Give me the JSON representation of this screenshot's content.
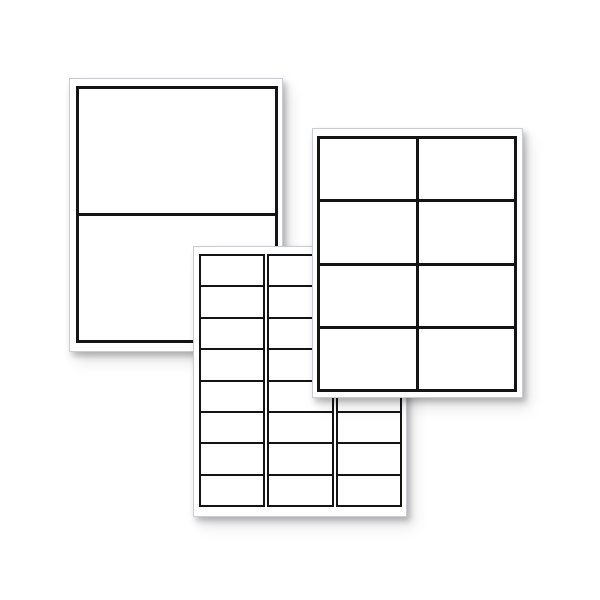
{
  "image_description": "Three blank white printer label sheets fanned out on a white background, no text",
  "colors": {
    "background": "#ffffff",
    "sheet": "#ffffff",
    "label_fill": "#ffffff",
    "label_border": "#141414",
    "sheet_edge": "#c9cdd1"
  },
  "sheets": [
    {
      "name": "half-sheet-labels",
      "labels_per_sheet": 2,
      "rows": 2,
      "columns": 1,
      "layout": "grid",
      "position": "back-left"
    },
    {
      "name": "shipping-labels",
      "labels_per_sheet": 8,
      "rows": 4,
      "columns": 2,
      "layout": "grid",
      "position": "right"
    },
    {
      "name": "address-labels",
      "labels_per_sheet": 24,
      "rows": 8,
      "columns": 3,
      "layout": "column-strips",
      "position": "front-bottom"
    }
  ]
}
